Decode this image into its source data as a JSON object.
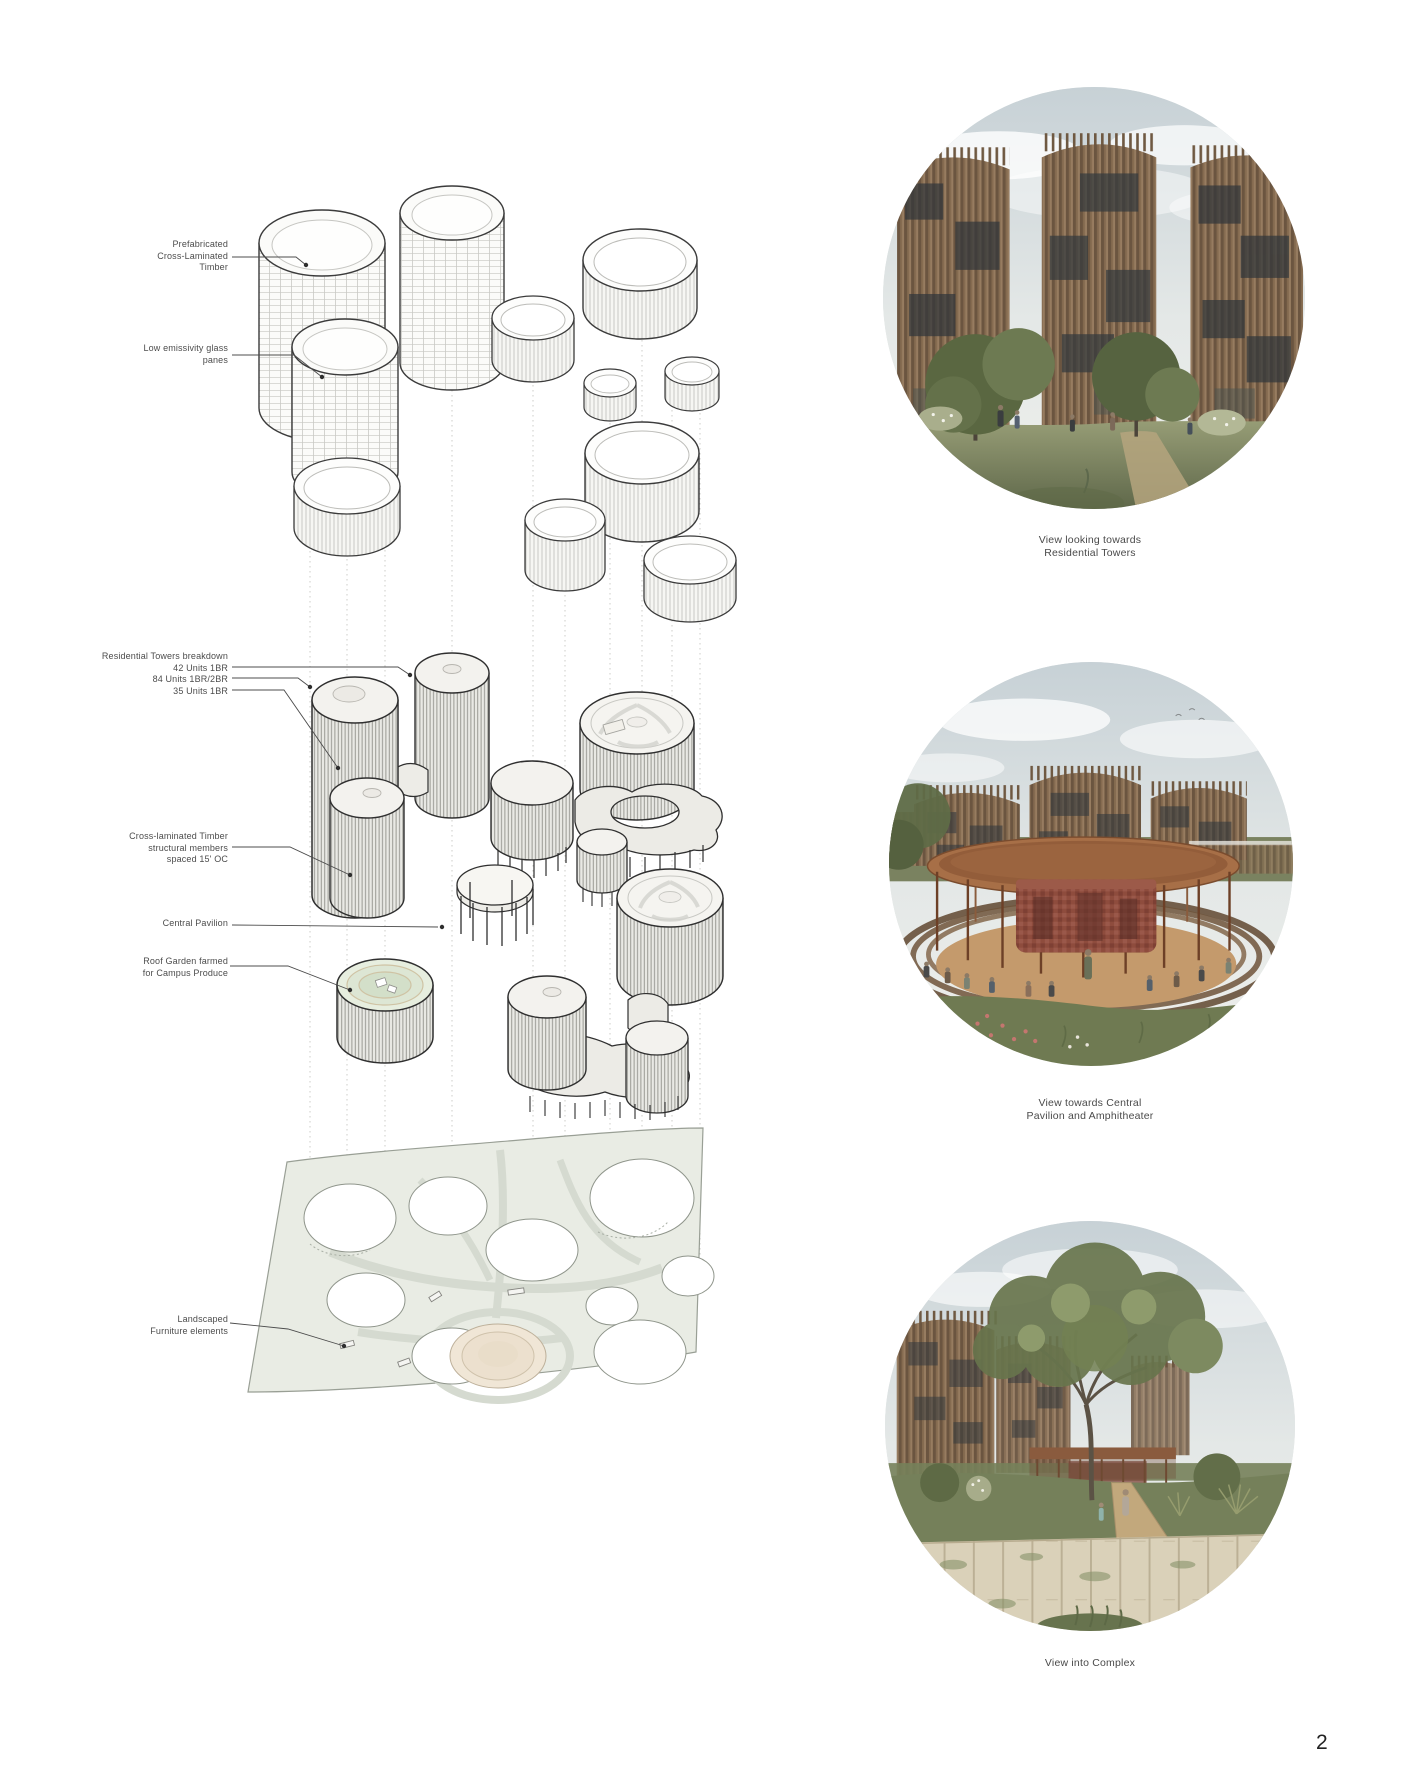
{
  "page": {
    "number": "2"
  },
  "diagram": {
    "annotations": [
      {
        "id": "prefab-clt",
        "text": "Prefabricated\nCross-Laminated\nTimber"
      },
      {
        "id": "low-e-glass",
        "text": "Low emissivity glass\npanes"
      },
      {
        "id": "towers-breakdown",
        "text": "Residential Towers breakdown\n42 Units 1BR\n84 Units 1BR/2BR\n35 Units 1BR"
      },
      {
        "id": "clt-members",
        "text": "Cross-laminated Timber\nstructural members\nspaced 15' OC"
      },
      {
        "id": "central-pavilion",
        "text": "Central Pavilion"
      },
      {
        "id": "roof-garden",
        "text": "Roof Garden farmed\nfor Campus Produce"
      },
      {
        "id": "landscaped-furniture",
        "text": "Landscaped\nFurniture elements"
      }
    ]
  },
  "figures": [
    {
      "id": "residential-towers-view",
      "caption": "View looking towards\nResidential Towers"
    },
    {
      "id": "central-pavilion-view",
      "caption": "View towards Central\nPavilion and Amphitheater"
    },
    {
      "id": "complex-view",
      "caption": "View into Complex"
    }
  ],
  "palette": {
    "tower_brown": "#7d6548",
    "timber_dark": "#6b5540",
    "grass_green": "#77805c",
    "sky_blue_gray": "#c7d1d6",
    "sand": "#c49a6c",
    "pavilion_red": "#8d4a3b",
    "site_slab": "#e9ece4",
    "roof_garden_green": "#dfe7d8",
    "line_dark": "#3b3b3b"
  }
}
